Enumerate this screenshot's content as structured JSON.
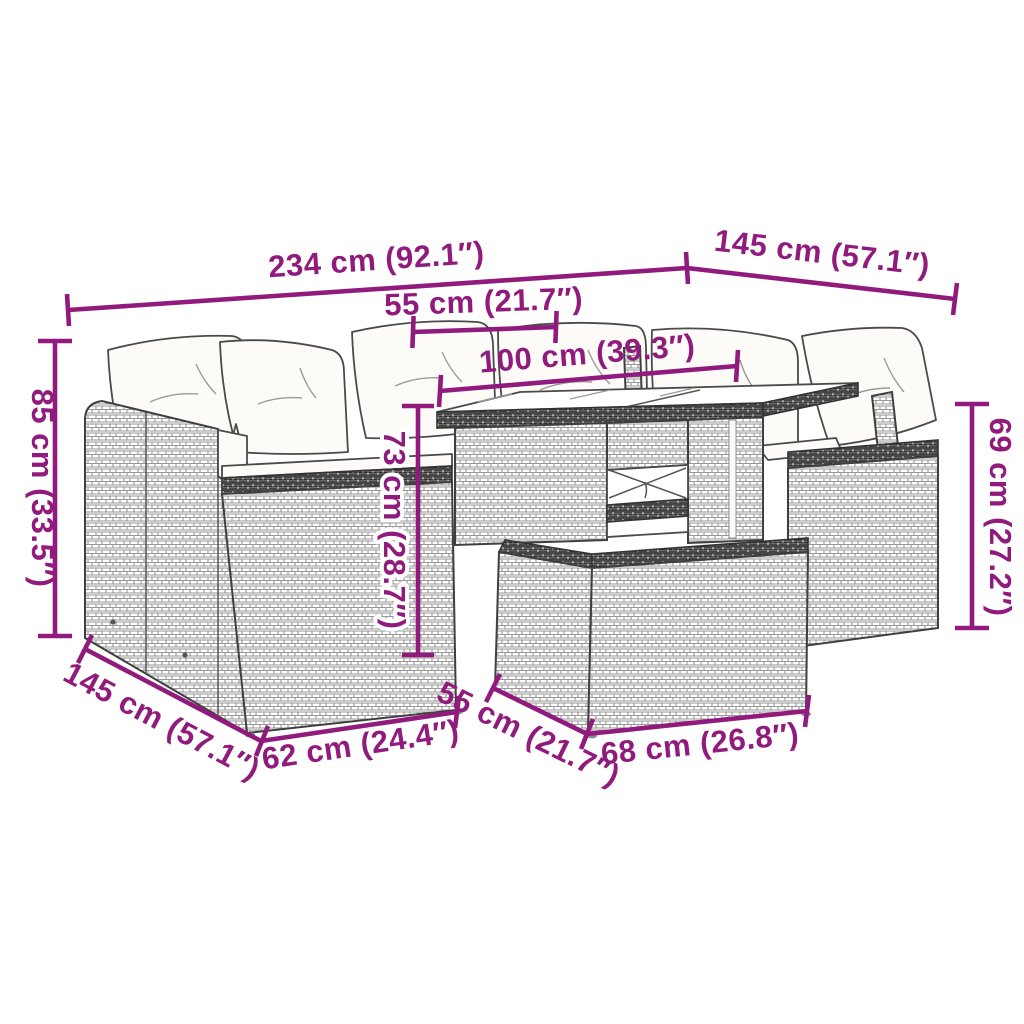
{
  "colors": {
    "dimension_purple": "#911B7D",
    "line_art_gray": "#3F3F3F",
    "weave_gray": "#9A9A9A",
    "cushion_white": "#FCFBF7",
    "background": "#FFFFFF"
  },
  "dimensions": {
    "overall_width": {
      "label": "234 cm (92.1″)",
      "cm": "234 cm",
      "inches": "92.1″"
    },
    "right_depth": {
      "label": "145 cm (57.1″)",
      "cm": "145 cm",
      "inches": "57.1″"
    },
    "table_top_width": {
      "label": "55 cm (21.7″)",
      "cm": "55 cm",
      "inches": "21.7″"
    },
    "table_length": {
      "label": "100 cm (39.3″)",
      "cm": "100 cm",
      "inches": "39.3″"
    },
    "back_height": {
      "label": "85 cm (33.5″)",
      "cm": "85 cm",
      "inches": "33.5″"
    },
    "table_height": {
      "label": "73 cm (28.7″)",
      "cm": "73 cm",
      "inches": "28.7″"
    },
    "side_height": {
      "label": "69 cm (27.2″)",
      "cm": "69 cm",
      "inches": "27.2″"
    },
    "left_depth": {
      "label": "145 cm (57.1″)",
      "cm": "145 cm",
      "inches": "57.1″"
    },
    "seat_front_width": {
      "label": "62 cm (24.4″)",
      "cm": "62 cm",
      "inches": "24.4″"
    },
    "bench_depth": {
      "label": "55 cm (21.7″)",
      "cm": "55 cm",
      "inches": "21.7″"
    },
    "bench_width": {
      "label": "68 cm (26.8″)",
      "cm": "68 cm",
      "inches": "26.8″"
    }
  }
}
